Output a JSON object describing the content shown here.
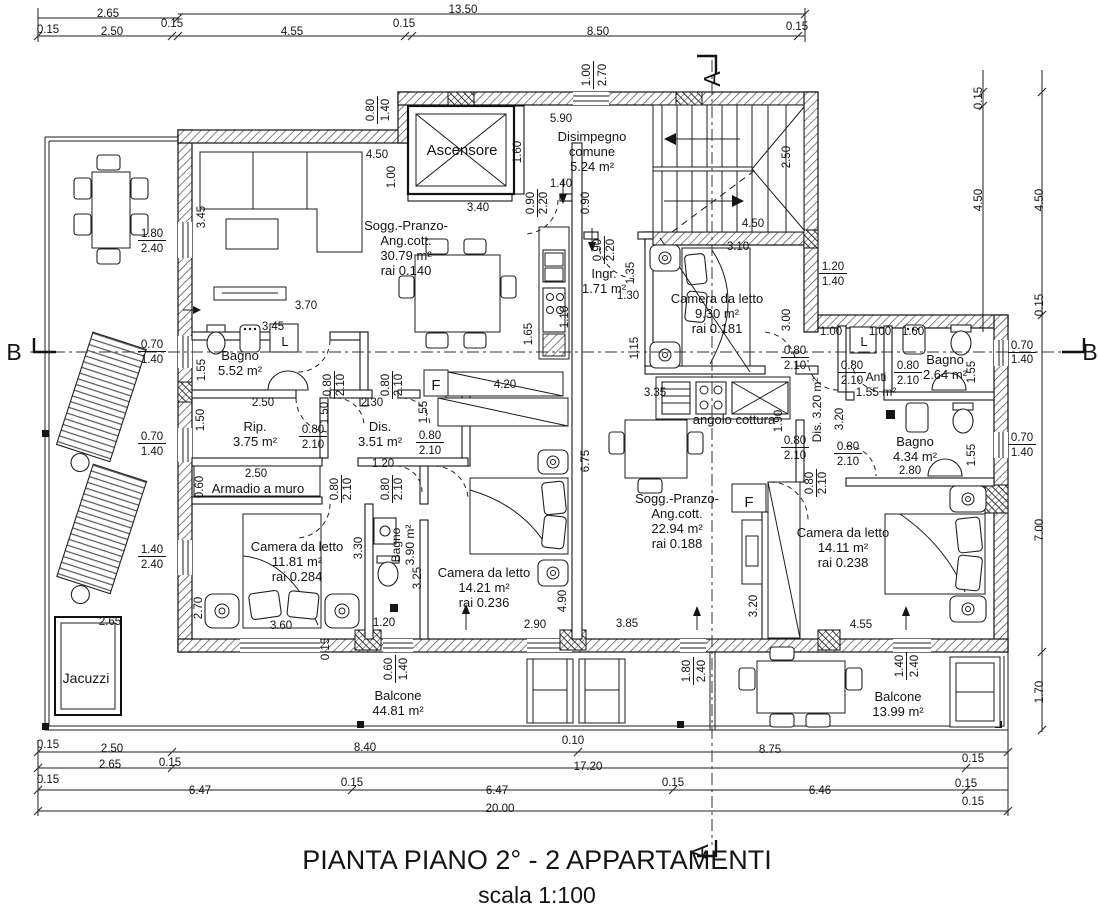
{
  "title": {
    "line1": "PIANTA PIANO 2° - 2 APPARTAMENTI",
    "line2": "scala 1:100"
  },
  "colors": {
    "line": "#141414",
    "background": "#ffffff",
    "hatch": "#4a4a4a"
  },
  "section_markers": [
    {
      "label": "A",
      "x": 720,
      "y": 79,
      "r": -90
    },
    {
      "label": "A",
      "x": 708,
      "y": 852,
      "r": -90
    },
    {
      "label": "B",
      "x": 14,
      "y": 360
    },
    {
      "label": "B",
      "x": 1090,
      "y": 360
    }
  ],
  "rooms": [
    {
      "n": "room-ascensore",
      "x": 462,
      "y": 155,
      "s": 15,
      "lines": [
        "Ascensore"
      ]
    },
    {
      "n": "room-disimpegno-comune",
      "x": 592,
      "y": 141,
      "s": 13,
      "lines": [
        "Disimpegno",
        "comune",
        "5.24 m²"
      ]
    },
    {
      "n": "room-soggiorno-apt1",
      "x": 406,
      "y": 230,
      "s": 13,
      "lines": [
        "Sogg.-Pranzo-",
        "Ang.cott.",
        "30.79 m²",
        "rai  0.140"
      ]
    },
    {
      "n": "room-ingresso",
      "x": 604,
      "y": 278,
      "s": 13,
      "lines": [
        "Ingr.",
        "1.71 m²"
      ]
    },
    {
      "n": "room-camera-930",
      "x": 717,
      "y": 303,
      "s": 13,
      "lines": [
        "Camera da letto",
        "9.30 m²",
        "rai  0.181"
      ]
    },
    {
      "n": "room-bagno-552",
      "x": 240,
      "y": 360,
      "s": 13,
      "lines": [
        "Bagno",
        "5.52 m²"
      ]
    },
    {
      "n": "room-rip",
      "x": 255,
      "y": 431,
      "s": 13,
      "lines": [
        "Rip.",
        "3.75 m²"
      ]
    },
    {
      "n": "room-dis-351",
      "x": 380,
      "y": 431,
      "s": 13,
      "lines": [
        "Dis.",
        "3.51 m²"
      ]
    },
    {
      "n": "room-armadio",
      "x": 258,
      "y": 493,
      "s": 13,
      "lines": [
        "Armadio a muro"
      ]
    },
    {
      "n": "room-camera-1181",
      "x": 297,
      "y": 551,
      "s": 13,
      "lines": [
        "Camera da letto",
        "11.81 m²",
        "rai  0.284"
      ]
    },
    {
      "n": "room-bagno-390",
      "x": 400,
      "y": 545,
      "s": 12,
      "r": -90,
      "lh": 14,
      "lines": [
        "Bagno",
        "3.90 m²"
      ]
    },
    {
      "n": "room-camera-1421",
      "x": 484,
      "y": 577,
      "s": 13,
      "lines": [
        "Camera da letto",
        "14.21 m²",
        "rai  0.236"
      ]
    },
    {
      "n": "room-soggiorno-apt2",
      "x": 677,
      "y": 503,
      "s": 13,
      "lines": [
        "Sogg.-Pranzo-",
        "Ang.cott.",
        "22.94 m²",
        "rai  0.188"
      ]
    },
    {
      "n": "room-angolo-cottura",
      "x": 734,
      "y": 424,
      "s": 13,
      "lines": [
        "angolo cottura"
      ]
    },
    {
      "n": "room-dis-320",
      "x": 821,
      "y": 410,
      "s": 12,
      "r": -90,
      "lines": [
        "Dis. 3.20 m²"
      ]
    },
    {
      "n": "room-anti",
      "x": 876,
      "y": 381,
      "s": 12,
      "lines": [
        "Anti",
        "1.55 m²"
      ]
    },
    {
      "n": "room-bagno-264",
      "x": 945,
      "y": 364,
      "s": 13,
      "lines": [
        "Bagno",
        "2.64 m²"
      ]
    },
    {
      "n": "room-bagno-434",
      "x": 915,
      "y": 446,
      "s": 13,
      "lines": [
        "Bagno",
        "4.34 m²"
      ]
    },
    {
      "n": "room-camera-1411",
      "x": 843,
      "y": 537,
      "s": 13,
      "lines": [
        "Camera da letto",
        "14.11 m²",
        "rai  0.238"
      ]
    },
    {
      "n": "room-jacuzzi",
      "x": 86,
      "y": 683,
      "s": 14,
      "lines": [
        "Jacuzzi"
      ]
    },
    {
      "n": "room-balcone-4481",
      "x": 398,
      "y": 700,
      "s": 13,
      "lines": [
        "Balcone",
        "44.81 m²"
      ]
    },
    {
      "n": "room-balcone-1399",
      "x": 898,
      "y": 701,
      "s": 13,
      "lines": [
        "Balcone",
        "13.99 m²"
      ]
    },
    {
      "n": "label-lavatrice-apt1",
      "x": 285,
      "y": 346,
      "s": 13,
      "lines": [
        "L"
      ]
    },
    {
      "n": "label-lavatrice-apt2",
      "x": 864,
      "y": 346,
      "s": 13,
      "lines": [
        "L"
      ]
    },
    {
      "n": "label-frigo-apt1",
      "x": 436,
      "y": 390,
      "s": 15,
      "lines": [
        "F"
      ]
    },
    {
      "n": "label-frigo-apt2",
      "x": 749,
      "y": 507,
      "s": 15,
      "lines": [
        "F"
      ]
    }
  ],
  "dimensions": [
    {
      "t": "2.65",
      "x": 108,
      "y": 17
    },
    {
      "t": "13.50",
      "x": 463,
      "y": 13
    },
    {
      "t": "0.15",
      "x": 48,
      "y": 33
    },
    {
      "t": "2.50",
      "x": 112,
      "y": 35
    },
    {
      "t": "0.15",
      "x": 172,
      "y": 27
    },
    {
      "t": "4.55",
      "x": 292,
      "y": 35
    },
    {
      "t": "0.15",
      "x": 404,
      "y": 27
    },
    {
      "t": "8.50",
      "x": 598,
      "y": 35
    },
    {
      "t": "0.15",
      "x": 797,
      "y": 30
    },
    {
      "t": "1.00",
      "x": 590,
      "y": 75,
      "r": -90,
      "u": 1
    },
    {
      "t": "2.70",
      "x": 606,
      "y": 75,
      "r": -90
    },
    {
      "t": "0.15",
      "x": 982,
      "y": 98,
      "r": -90
    },
    {
      "t": "4.50",
      "x": 982,
      "y": 200,
      "r": -90
    },
    {
      "t": "4.50",
      "x": 1043,
      "y": 200,
      "r": -90
    },
    {
      "t": "0.15",
      "x": 1043,
      "y": 305,
      "r": -90
    },
    {
      "t": "0.80",
      "x": 374,
      "y": 110,
      "r": -90,
      "u": 1
    },
    {
      "t": "1.40",
      "x": 389,
      "y": 110,
      "r": -90
    },
    {
      "t": "4.50",
      "x": 377,
      "y": 158
    },
    {
      "t": "1.00",
      "x": 395,
      "y": 177,
      "r": -90
    },
    {
      "t": "3.40",
      "x": 478,
      "y": 211
    },
    {
      "t": "5.90",
      "x": 561,
      "y": 122
    },
    {
      "t": "1.60",
      "x": 521,
      "y": 152,
      "r": -90
    },
    {
      "t": "1.40",
      "x": 561,
      "y": 187
    },
    {
      "t": "0.90",
      "x": 534,
      "y": 203,
      "r": -90,
      "u": 1
    },
    {
      "t": "2.20",
      "x": 547,
      "y": 203,
      "r": -90
    },
    {
      "t": "0.90",
      "x": 589,
      "y": 203,
      "r": -90
    },
    {
      "t": "0.90",
      "x": 601,
      "y": 250,
      "r": -90,
      "u": 1
    },
    {
      "t": "2.20",
      "x": 614,
      "y": 250,
      "r": -90
    },
    {
      "t": "2.50",
      "x": 790,
      "y": 157,
      "r": -90
    },
    {
      "t": "4.50",
      "x": 753,
      "y": 227
    },
    {
      "t": "3.10",
      "x": 738,
      "y": 250
    },
    {
      "t": "1.20",
      "x": 833,
      "y": 270,
      "u": 1
    },
    {
      "t": "1.40",
      "x": 833,
      "y": 285
    },
    {
      "t": "1.35",
      "x": 634,
      "y": 273,
      "r": -90
    },
    {
      "t": "1.30",
      "x": 628,
      "y": 299
    },
    {
      "t": "1.15",
      "x": 638,
      "y": 348,
      "r": -90
    },
    {
      "t": "1.10",
      "x": 568,
      "y": 317,
      "r": -90
    },
    {
      "t": "1.65",
      "x": 532,
      "y": 334,
      "r": -90
    },
    {
      "t": "3.00",
      "x": 790,
      "y": 320,
      "r": -90
    },
    {
      "t": "1.00",
      "x": 831,
      "y": 335
    },
    {
      "t": "1.00",
      "x": 880,
      "y": 335
    },
    {
      "t": "1.60",
      "x": 913,
      "y": 335
    },
    {
      "t": "0.70",
      "x": 1022,
      "y": 349,
      "u": 1
    },
    {
      "t": "1.40",
      "x": 1022,
      "y": 363
    },
    {
      "t": "0.70",
      "x": 1022,
      "y": 441,
      "u": 1
    },
    {
      "t": "1.40",
      "x": 1022,
      "y": 456
    },
    {
      "t": "7.00",
      "x": 1043,
      "y": 530,
      "r": -90
    },
    {
      "t": "1.70",
      "x": 1043,
      "y": 692,
      "r": -90
    },
    {
      "t": "1.80",
      "x": 152,
      "y": 237,
      "u": 1
    },
    {
      "t": "2.40",
      "x": 152,
      "y": 252
    },
    {
      "t": "3.45",
      "x": 205,
      "y": 217,
      "r": -90
    },
    {
      "t": "3.70",
      "x": 306,
      "y": 309
    },
    {
      "t": "3.45",
      "x": 273,
      "y": 330
    },
    {
      "t": "0.70",
      "x": 152,
      "y": 348,
      "u": 1
    },
    {
      "t": "1.40",
      "x": 152,
      "y": 363
    },
    {
      "t": "1.55",
      "x": 205,
      "y": 370,
      "r": -90
    },
    {
      "t": "0.80",
      "x": 331,
      "y": 385,
      "r": -90,
      "u": 1
    },
    {
      "t": "2.10",
      "x": 344,
      "y": 385,
      "r": -90
    },
    {
      "t": "0.80",
      "x": 389,
      "y": 385,
      "r": -90,
      "u": 1
    },
    {
      "t": "2.10",
      "x": 402,
      "y": 385,
      "r": -90
    },
    {
      "t": "2.50",
      "x": 263,
      "y": 406
    },
    {
      "t": "1.50",
      "x": 204,
      "y": 420,
      "r": -90
    },
    {
      "t": "1.50",
      "x": 328,
      "y": 413,
      "r": -90
    },
    {
      "t": "2.30",
      "x": 372,
      "y": 406
    },
    {
      "t": "1.55",
      "x": 427,
      "y": 412,
      "r": -90
    },
    {
      "t": "0.80",
      "x": 313,
      "y": 433,
      "u": 1
    },
    {
      "t": "2.10",
      "x": 313,
      "y": 448
    },
    {
      "t": "0.80",
      "x": 430,
      "y": 439,
      "u": 1
    },
    {
      "t": "2.10",
      "x": 430,
      "y": 454
    },
    {
      "t": "0.70",
      "x": 152,
      "y": 440,
      "u": 1
    },
    {
      "t": "1.40",
      "x": 152,
      "y": 455
    },
    {
      "t": "1.20",
      "x": 383,
      "y": 467
    },
    {
      "t": "2.50",
      "x": 256,
      "y": 477
    },
    {
      "t": "0.60",
      "x": 203,
      "y": 487,
      "r": -90
    },
    {
      "t": "0.80",
      "x": 338,
      "y": 489,
      "r": -90,
      "u": 1
    },
    {
      "t": "2.10",
      "x": 351,
      "y": 489,
      "r": -90
    },
    {
      "t": "0.80",
      "x": 389,
      "y": 489,
      "r": -90,
      "u": 1
    },
    {
      "t": "2.10",
      "x": 402,
      "y": 489,
      "r": -90
    },
    {
      "t": "3.30",
      "x": 362,
      "y": 548,
      "r": -90
    },
    {
      "t": "3.25",
      "x": 421,
      "y": 578,
      "r": -90
    },
    {
      "t": "1.40",
      "x": 152,
      "y": 553,
      "u": 1
    },
    {
      "t": "2.40",
      "x": 152,
      "y": 568
    },
    {
      "t": "2.70",
      "x": 202,
      "y": 608,
      "r": -90
    },
    {
      "t": "3.60",
      "x": 281,
      "y": 629
    },
    {
      "t": "1.20",
      "x": 384,
      "y": 626
    },
    {
      "t": "2.65",
      "x": 110,
      "y": 625
    },
    {
      "t": "4.20",
      "x": 505,
      "y": 388
    },
    {
      "t": "6.75",
      "x": 589,
      "y": 461,
      "r": -90
    },
    {
      "t": "4.90",
      "x": 566,
      "y": 601,
      "r": -90
    },
    {
      "t": "2.90",
      "x": 535,
      "y": 628
    },
    {
      "t": "3.85",
      "x": 627,
      "y": 627
    },
    {
      "t": "3.35",
      "x": 655,
      "y": 396
    },
    {
      "t": "1.90",
      "x": 782,
      "y": 421,
      "r": -90
    },
    {
      "t": "0.80",
      "x": 795,
      "y": 354,
      "u": 1
    },
    {
      "t": "2.10",
      "x": 795,
      "y": 369
    },
    {
      "t": "0.80",
      "x": 852,
      "y": 369,
      "u": 1
    },
    {
      "t": "2.10",
      "x": 852,
      "y": 384
    },
    {
      "t": "0.80",
      "x": 908,
      "y": 369,
      "u": 1
    },
    {
      "t": "2.10",
      "x": 908,
      "y": 384
    },
    {
      "t": "0.80",
      "x": 795,
      "y": 444,
      "u": 1
    },
    {
      "t": "2.10",
      "x": 795,
      "y": 459
    },
    {
      "t": "0.80",
      "x": 848,
      "y": 450,
      "u": 1
    },
    {
      "t": "2.10",
      "x": 848,
      "y": 465
    },
    {
      "t": "3.20",
      "x": 843,
      "y": 419,
      "r": -90
    },
    {
      "t": "2.80",
      "x": 910,
      "y": 474
    },
    {
      "t": "1.55",
      "x": 975,
      "y": 372,
      "r": -90
    },
    {
      "t": "1.55",
      "x": 975,
      "y": 455,
      "r": -90
    },
    {
      "t": "0.80",
      "x": 813,
      "y": 483,
      "r": -90,
      "u": 1
    },
    {
      "t": "2.10",
      "x": 826,
      "y": 483,
      "r": -90
    },
    {
      "t": "3.20",
      "x": 757,
      "y": 606,
      "r": -90
    },
    {
      "t": "4.55",
      "x": 861,
      "y": 628
    },
    {
      "t": "1.40",
      "x": 903,
      "y": 666,
      "r": -90,
      "u": 1
    },
    {
      "t": "2.40",
      "x": 918,
      "y": 666,
      "r": -90
    },
    {
      "t": "1.80",
      "x": 690,
      "y": 671,
      "r": -90,
      "u": 1
    },
    {
      "t": "2.40",
      "x": 705,
      "y": 671,
      "r": -90
    },
    {
      "t": "0.60",
      "x": 392,
      "y": 669,
      "r": -90,
      "u": 1
    },
    {
      "t": "1.40",
      "x": 407,
      "y": 669,
      "r": -90
    },
    {
      "t": "0.15",
      "x": 329,
      "y": 649,
      "r": -90
    },
    {
      "t": "0.10",
      "x": 573,
      "y": 744
    },
    {
      "t": "0.15",
      "x": 48,
      "y": 748
    },
    {
      "t": "2.50",
      "x": 112,
      "y": 752
    },
    {
      "t": "8.40",
      "x": 365,
      "y": 751
    },
    {
      "t": "8.75",
      "x": 770,
      "y": 753
    },
    {
      "t": "2.65",
      "x": 110,
      "y": 768
    },
    {
      "t": "0.15",
      "x": 170,
      "y": 766
    },
    {
      "t": "17.20",
      "x": 588,
      "y": 770
    },
    {
      "t": "0.15",
      "x": 973,
      "y": 762
    },
    {
      "t": "0.15",
      "x": 48,
      "y": 783
    },
    {
      "t": "6.47",
      "x": 200,
      "y": 794
    },
    {
      "t": "0.15",
      "x": 352,
      "y": 786
    },
    {
      "t": "6.47",
      "x": 497,
      "y": 794
    },
    {
      "t": "0.15",
      "x": 673,
      "y": 786
    },
    {
      "t": "6.46",
      "x": 820,
      "y": 794
    },
    {
      "t": "0.15",
      "x": 966,
      "y": 787
    },
    {
      "t": "20.00",
      "x": 500,
      "y": 812
    },
    {
      "t": "0.15",
      "x": 973,
      "y": 805
    }
  ]
}
